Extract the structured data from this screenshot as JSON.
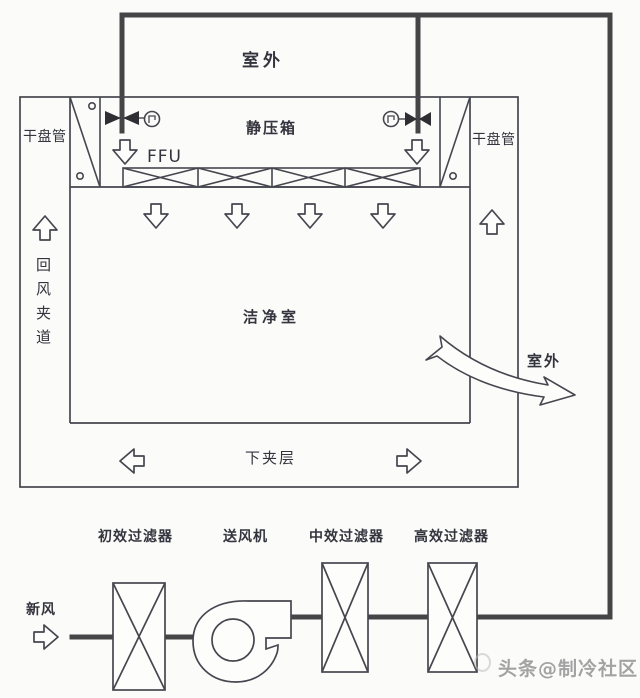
{
  "diagram": {
    "outdoor_top_label": "室外",
    "plenum_label": "静压箱",
    "ffu_label": "FFU",
    "dry_coil_left_label": "干盘管",
    "dry_coil_right_label": "干盘管",
    "return_air_passage_label": "回风夹道",
    "cleanroom_label": "洁净室",
    "outdoor_exit_label": "室外",
    "lower_plenum_label": "下夹层",
    "fresh_air_label": "新风",
    "primary_filter_label": "初效过滤器",
    "supply_fan_label": "送风机",
    "medium_filter_label": "中效过滤器",
    "hepa_filter_label": "高效过滤器",
    "watermark": "头条@制冷社区",
    "colors": {
      "thin_line": "#46464f",
      "duct_line": "#454548",
      "text": "#34343e",
      "background": "#fbfbfa",
      "watermark": "#a3a3a3"
    }
  }
}
